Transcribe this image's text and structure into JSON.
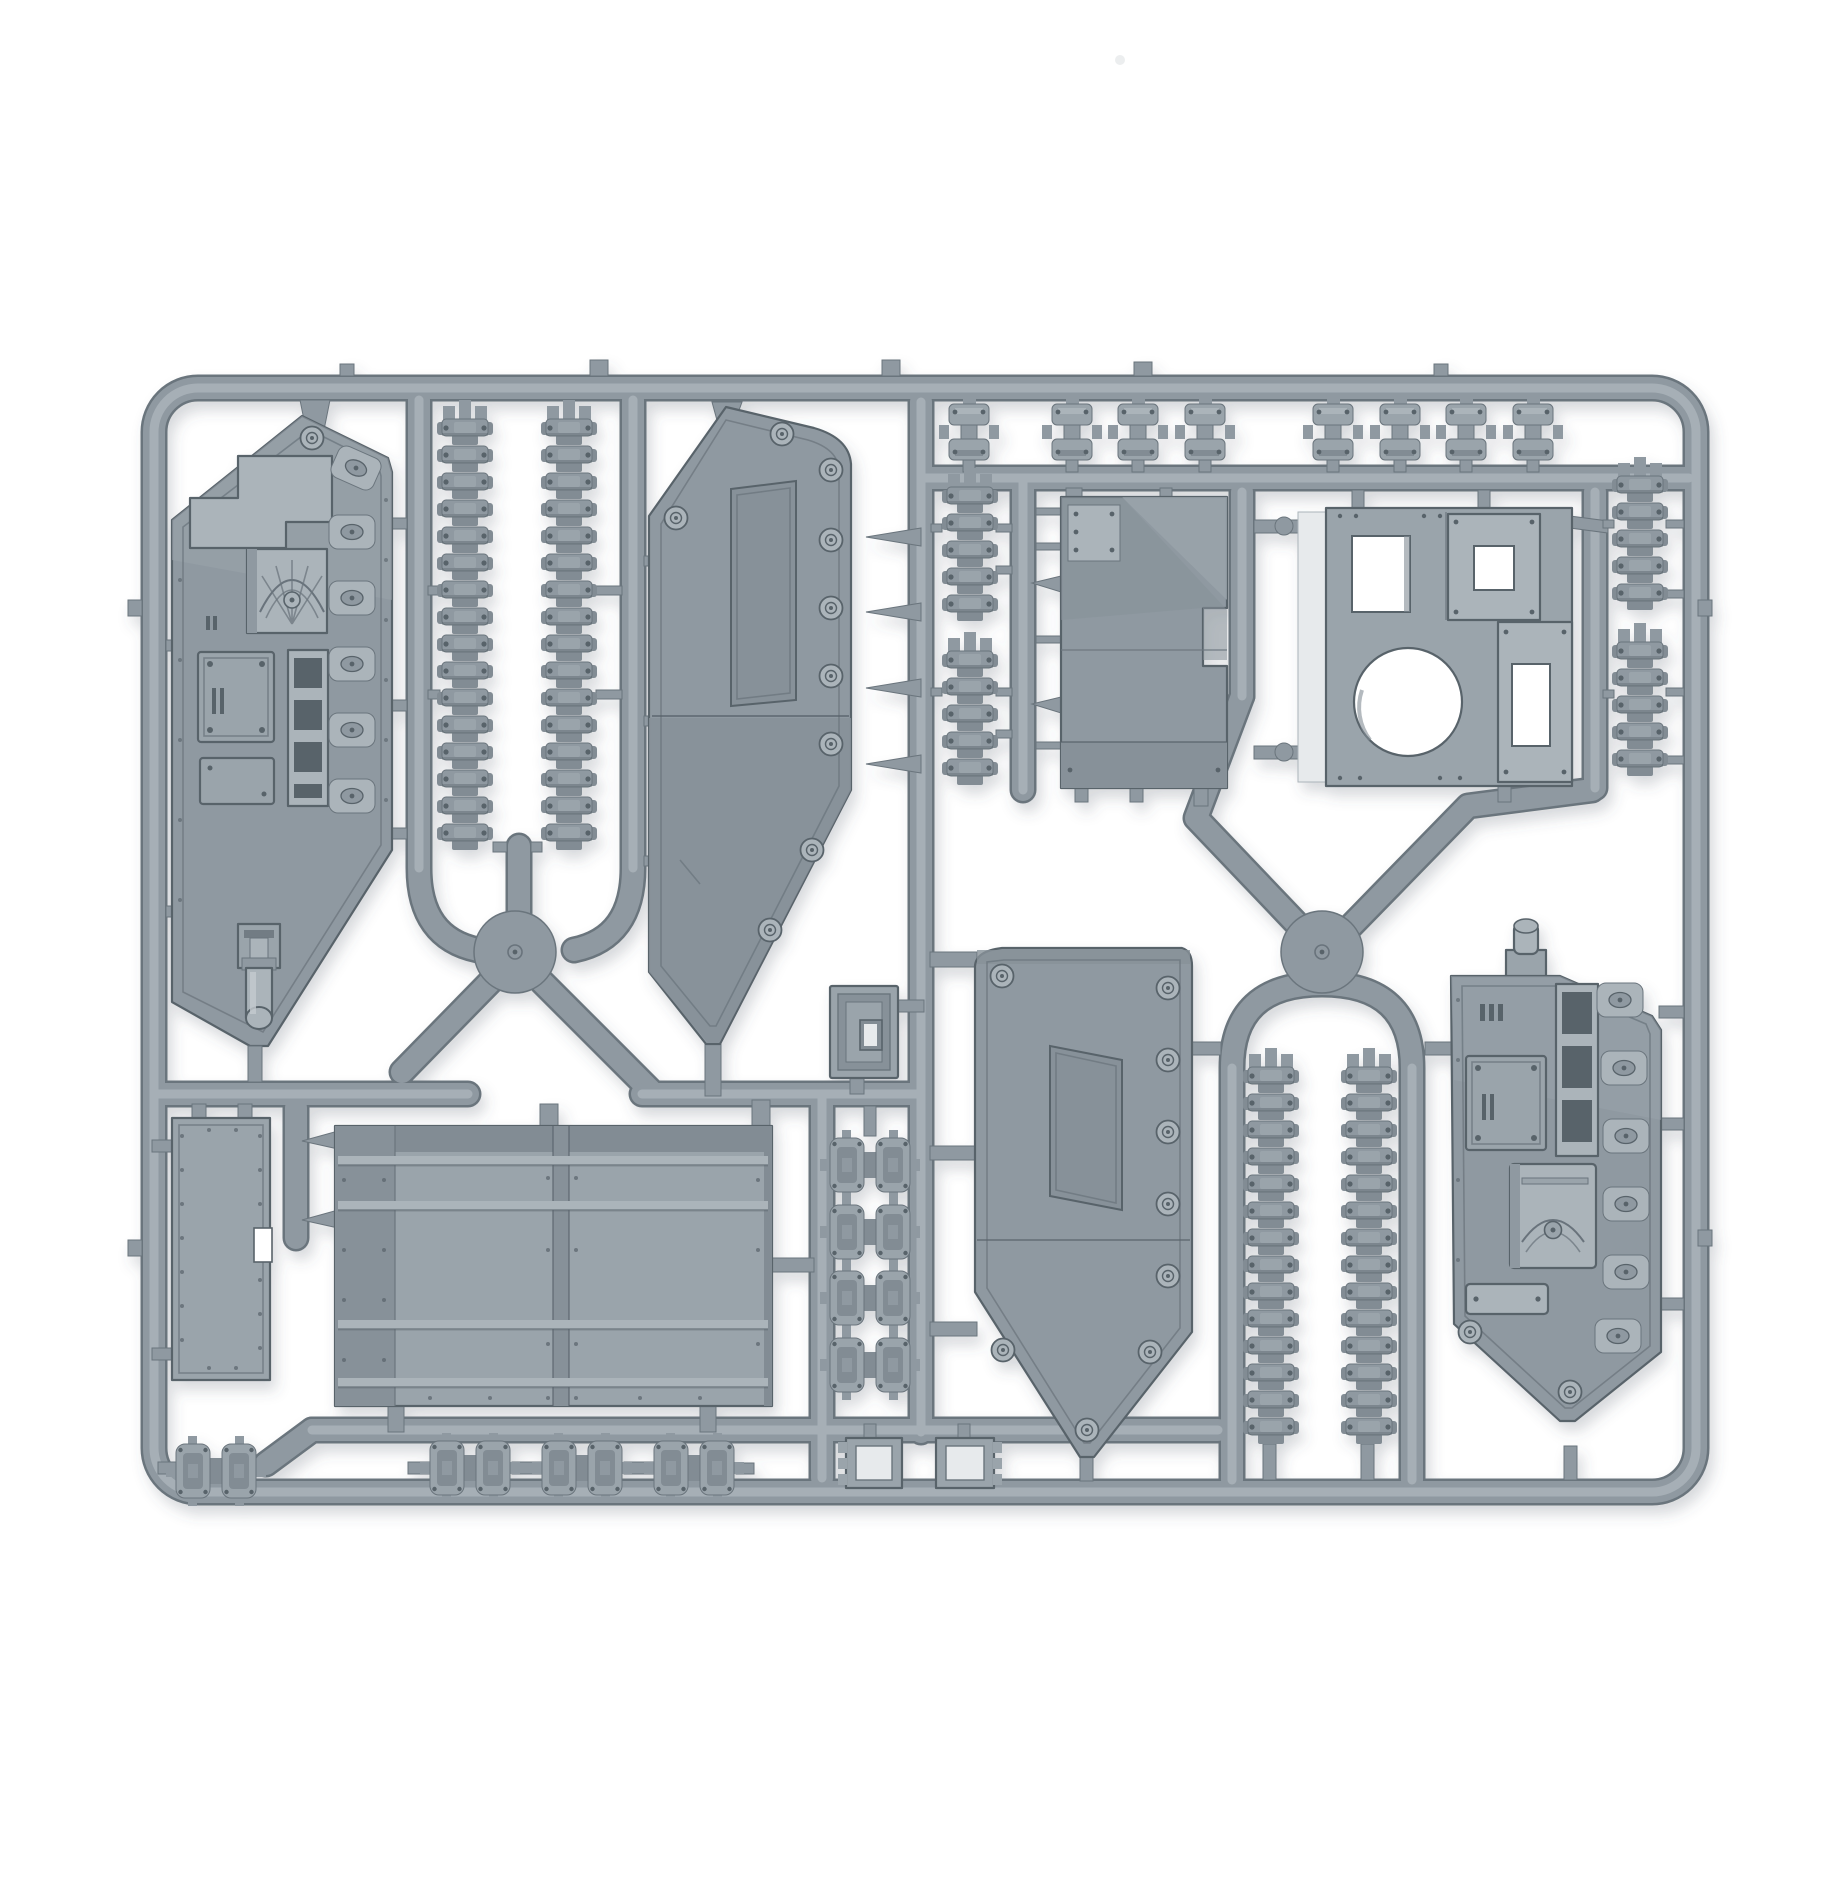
{
  "meta": {
    "description": "Photograph of a grey plastic injection-moulded model tank sprue on a white background",
    "object": "plastic model kit sprue",
    "visible_text": ""
  },
  "colors": {
    "bg": "#ffffff",
    "edge": "#6b757d",
    "base": "#8f99a1",
    "base2": "#879199",
    "mid": "#9aa4ab",
    "light": "#abb4ba",
    "hi": "#c4cbd0",
    "deep": "#59636b",
    "track": "#828c94",
    "whitehi": "#e7eaec"
  },
  "parts": {
    "frame": {
      "label": "rectangular sprue frame with runners",
      "count": 1
    },
    "hull_left": {
      "label": "left hull side panel with eagle hatch and gun barrel",
      "count": 1
    },
    "hull_right": {
      "label": "right hull side panel with hatches and exhaust rack",
      "count": 1
    },
    "door_left": {
      "label": "large angled side door panel (left)",
      "count": 1
    },
    "door_right": {
      "label": "large angled side door panel (right)",
      "count": 1
    },
    "ramp": {
      "label": "large access ramp / floor panel",
      "count": 1
    },
    "skirt_panel": {
      "label": "rectangular side skirt panel",
      "count": 1
    },
    "glacis_plate": {
      "label": "angled glacis armour plate with notch",
      "count": 1
    },
    "turret_plate": {
      "label": "turret mounting plate with round and square openings",
      "count": 1
    },
    "access_hatch": {
      "label": "small square access hatch",
      "count": 1
    },
    "track_long": {
      "label": "long track run",
      "count": 4
    },
    "track_short": {
      "label": "short track run",
      "count": 4
    },
    "track_clip": {
      "label": "small track link clip",
      "count": 8
    },
    "bogie_clip": {
      "label": "twin suspension bogie clip",
      "count": 8
    },
    "stowage_box": {
      "label": "small open stowage box",
      "count": 2
    },
    "hub": {
      "label": "round runner hub",
      "count": 2
    }
  }
}
